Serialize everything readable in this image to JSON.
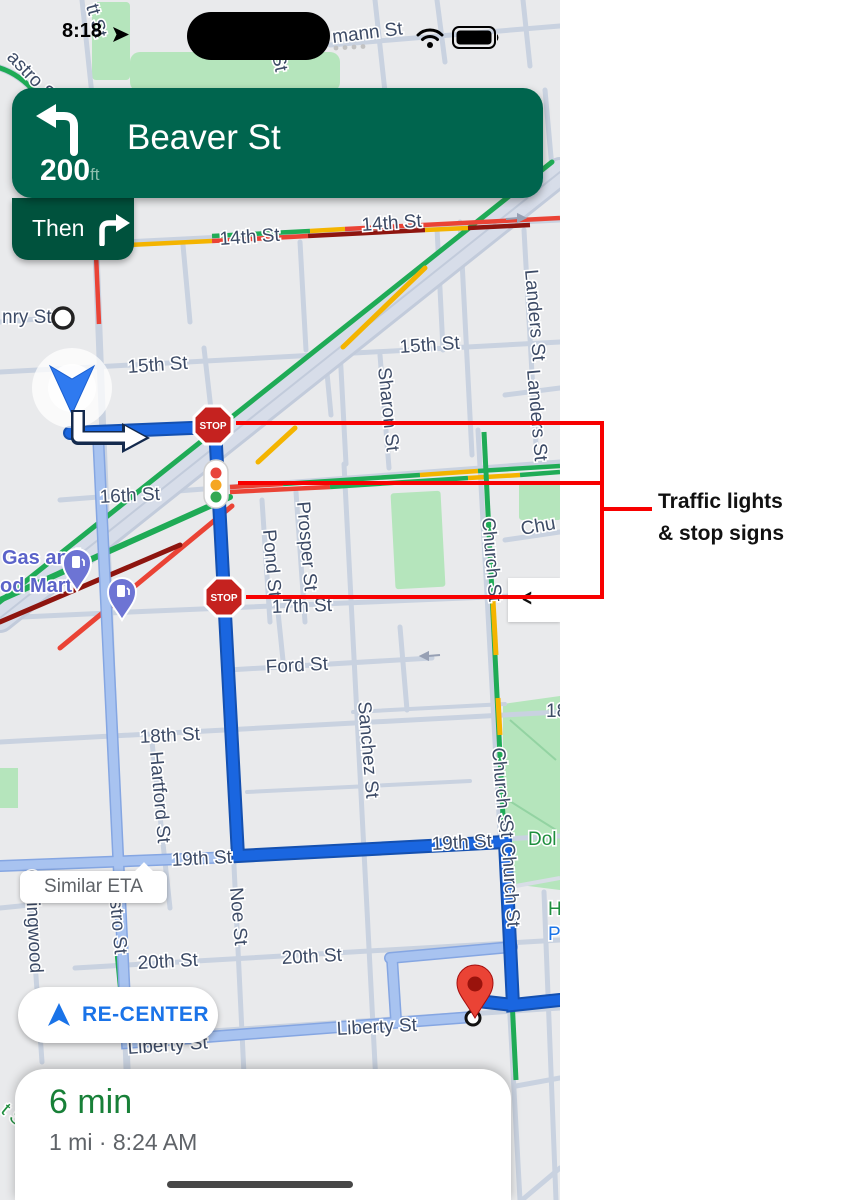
{
  "status_bar": {
    "time": "8:18"
  },
  "navigation": {
    "distance": "200",
    "distance_unit": "ft",
    "street": "Beaver St",
    "then_label": "Then"
  },
  "map": {
    "stop_sign_text": "STOP",
    "route_tooltip": "Similar ETA",
    "panel_chevron": "<",
    "labels": [
      "tt St",
      "astro S",
      "mann St",
      "St",
      "14th St",
      "14th St",
      "nry St",
      "15th St",
      "15th St",
      "Sharon St",
      "Landers St",
      "Landers St",
      "16th St",
      "Chu",
      "Church St",
      "Pond St",
      "Prosper St",
      "17th St",
      "Ford St",
      "18th St",
      "18",
      "Hartford St",
      "Sanchez St",
      "Church St",
      "St Church St",
      "Dol",
      "H",
      "P",
      "19th St",
      "19th St",
      "Collingwood",
      "stro St",
      "Noe St",
      "20th St",
      "20th St",
      "Liberty St",
      "Liberty St",
      "t S",
      "Gas and",
      "od Mart"
    ]
  },
  "recenter_button": {
    "label": "RE-CENTER"
  },
  "trip_summary": {
    "duration": "6 min",
    "details": "1 mi · 8:24 AM"
  },
  "annotation": {
    "line1": "Traffic lights",
    "line2": "& stop signs"
  },
  "colors": {
    "banner_green": "#00654e",
    "route_blue": "#1a66e0",
    "annotation_red": "#f80000",
    "eta_green": "#188038",
    "recenter_blue": "#1a73e8"
  }
}
